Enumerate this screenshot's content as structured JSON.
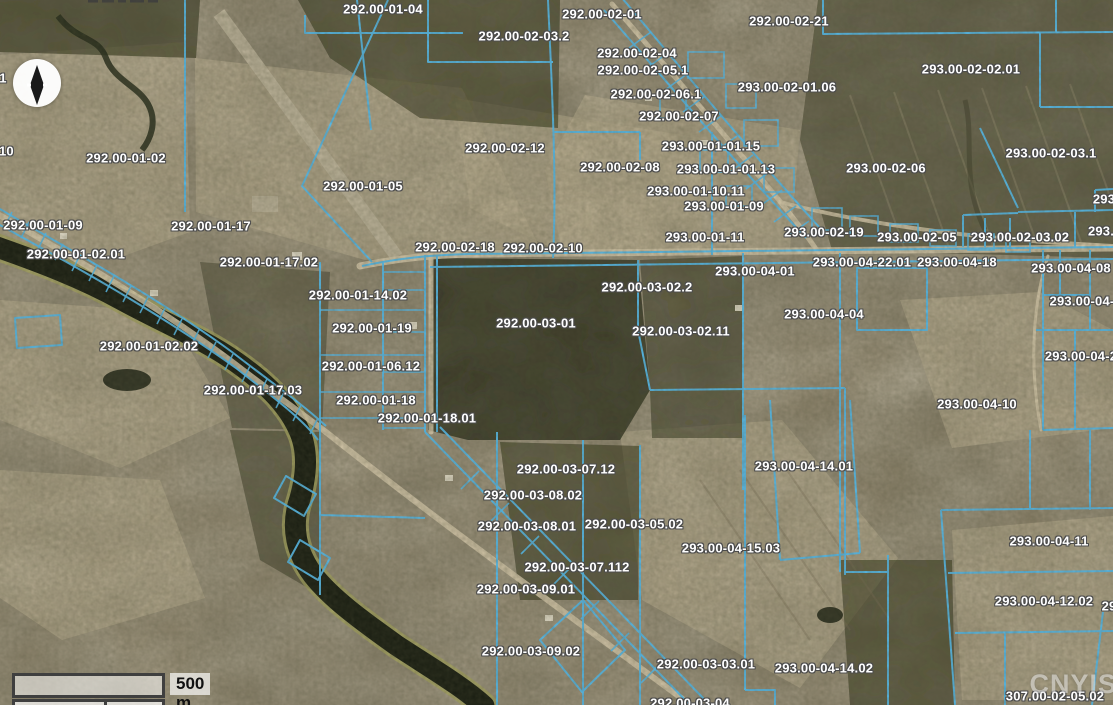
{
  "map": {
    "attribution": "CNYIS",
    "scale_bar": {
      "label": "500 m"
    },
    "colors": {
      "parcel_line": "#54b8e8",
      "label_text": "#ffffff",
      "label_halo": "#4c4c4c",
      "water": "#1a1e12",
      "shoreline": "#a2a15e",
      "road": "#d2c6a8",
      "runway": "#b9b098",
      "attribution_text": "#e6e6e6"
    },
    "labels": [
      {
        "text": "292.00-01-04",
        "x": 383,
        "y": 9
      },
      {
        "text": "292.00-02-01",
        "x": 602,
        "y": 14
      },
      {
        "text": "292.00-02-21",
        "x": 789,
        "y": 21
      },
      {
        "text": "292.00-02-03.2",
        "x": 524,
        "y": 36
      },
      {
        "text": "292.00-02-04",
        "x": 637,
        "y": 53
      },
      {
        "text": "293.00-02-02.01",
        "x": 971,
        "y": 69
      },
      {
        "text": "292.00-02-05.1",
        "x": 643,
        "y": 70
      },
      {
        "text": "1",
        "x": 3,
        "y": 78
      },
      {
        "text": "293.00-02-01.06",
        "x": 787,
        "y": 87
      },
      {
        "text": "292.00-02-06.1",
        "x": 656,
        "y": 94
      },
      {
        "text": "292.00-02-07",
        "x": 679,
        "y": 116
      },
      {
        "text": "293.00-01-01.15",
        "x": 711,
        "y": 146
      },
      {
        "text": "292.00-02-12",
        "x": 505,
        "y": 148
      },
      {
        "text": "292.00-01-10",
        "x": -26,
        "y": 151
      },
      {
        "text": "293.00-02-03.1",
        "x": 1051,
        "y": 153
      },
      {
        "text": "292.00-01-02",
        "x": 126,
        "y": 158
      },
      {
        "text": "292.00-02-08",
        "x": 620,
        "y": 167
      },
      {
        "text": "293.00-02-06",
        "x": 886,
        "y": 168
      },
      {
        "text": "293.00-01-01.13",
        "x": 726,
        "y": 169
      },
      {
        "text": "292.00-01-05",
        "x": 363,
        "y": 186
      },
      {
        "text": "293.00-01-10.11",
        "x": 696,
        "y": 191
      },
      {
        "text": "293",
        "x": 1104,
        "y": 199
      },
      {
        "text": "293.00-01-09",
        "x": 724,
        "y": 206
      },
      {
        "text": "292.00-01-09",
        "x": 43,
        "y": 225
      },
      {
        "text": "292.00-01-17",
        "x": 211,
        "y": 226
      },
      {
        "text": "293.",
        "x": 1101,
        "y": 231
      },
      {
        "text": "293.00-02-19",
        "x": 824,
        "y": 232
      },
      {
        "text": "293.00-01-11",
        "x": 705,
        "y": 237
      },
      {
        "text": "293.00-02-05",
        "x": 917,
        "y": 237
      },
      {
        "text": "293.00-02-03.02",
        "x": 1020,
        "y": 237
      },
      {
        "text": "292.00-02-18",
        "x": 455,
        "y": 247
      },
      {
        "text": "292.00-02-10",
        "x": 543,
        "y": 248
      },
      {
        "text": "292.00-01-02.01",
        "x": 76,
        "y": 254
      },
      {
        "text": "292.00-01-17.02",
        "x": 269,
        "y": 262
      },
      {
        "text": "293.00-04-22.01",
        "x": 862,
        "y": 262
      },
      {
        "text": "293.00-04-18",
        "x": 957,
        "y": 262
      },
      {
        "text": "293.00-04-08",
        "x": 1071,
        "y": 268
      },
      {
        "text": "293.00-04-01",
        "x": 755,
        "y": 271
      },
      {
        "text": "292.00-03-02.2",
        "x": 647,
        "y": 287
      },
      {
        "text": "292.00-01-14.02",
        "x": 358,
        "y": 295
      },
      {
        "text": "293.00-04-",
        "x": 1082,
        "y": 301
      },
      {
        "text": "293.00-04-04",
        "x": 824,
        "y": 314
      },
      {
        "text": "292.00-03-01",
        "x": 536,
        "y": 323
      },
      {
        "text": "292.00-01-19",
        "x": 372,
        "y": 328
      },
      {
        "text": "292.00-03-02.11",
        "x": 681,
        "y": 331
      },
      {
        "text": "292.00-01-02.02",
        "x": 149,
        "y": 346
      },
      {
        "text": "293.00-04-2",
        "x": 1081,
        "y": 356
      },
      {
        "text": "292.00-01-06.12",
        "x": 371,
        "y": 366
      },
      {
        "text": "292.00-01-17.03",
        "x": 253,
        "y": 390
      },
      {
        "text": "292.00-01-18",
        "x": 376,
        "y": 400
      },
      {
        "text": "293.00-04-10",
        "x": 977,
        "y": 404
      },
      {
        "text": "292.00-01-18.01",
        "x": 427,
        "y": 418
      },
      {
        "text": "293.00-04-14.01",
        "x": 804,
        "y": 466
      },
      {
        "text": "292.00-03-07.12",
        "x": 566,
        "y": 469
      },
      {
        "text": "292.00-03-08.02",
        "x": 533,
        "y": 495
      },
      {
        "text": "292.00-03-05.02",
        "x": 634,
        "y": 524
      },
      {
        "text": "292.00-03-08.01",
        "x": 527,
        "y": 526
      },
      {
        "text": "293.00-04-11",
        "x": 1049,
        "y": 541
      },
      {
        "text": "293.00-04-15.03",
        "x": 731,
        "y": 548
      },
      {
        "text": "292.00-03-07.112",
        "x": 577,
        "y": 567
      },
      {
        "text": "292.00-03-09.01",
        "x": 526,
        "y": 589
      },
      {
        "text": "293.00-04-12.02",
        "x": 1044,
        "y": 601
      },
      {
        "text": "29",
        "x": 1109,
        "y": 606
      },
      {
        "text": "292.00-03-09.02",
        "x": 531,
        "y": 651
      },
      {
        "text": "292.00-03-03.01",
        "x": 706,
        "y": 664
      },
      {
        "text": "293.00-04-14.02",
        "x": 824,
        "y": 668
      },
      {
        "text": "307.00-02-05.02",
        "x": 1055,
        "y": 696
      },
      {
        "text": "292.00-03-04",
        "x": 690,
        "y": 703
      }
    ]
  }
}
